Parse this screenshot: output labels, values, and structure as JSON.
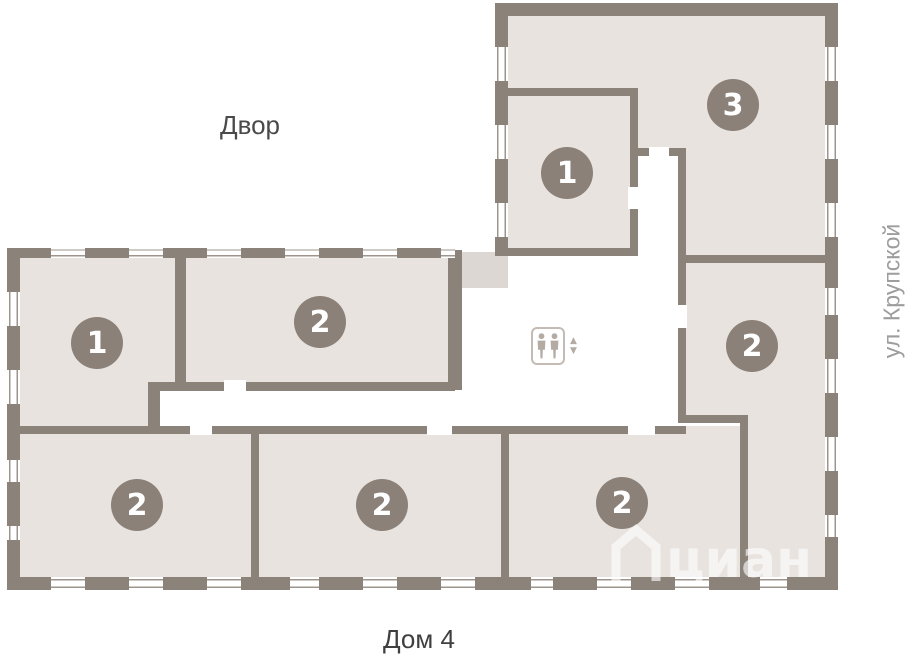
{
  "plan": {
    "area_labels": {
      "courtyard": "Двор",
      "street": "ул. Крупской",
      "house": "Дом 4"
    },
    "watermark_text": "циан",
    "unit_badges": [
      {
        "room": "top-wing-inner",
        "label": "1"
      },
      {
        "room": "top-wing-main",
        "label": "3"
      },
      {
        "room": "right-middle",
        "label": "2"
      },
      {
        "room": "left-upper-west",
        "label": "1"
      },
      {
        "room": "left-upper-east",
        "label": "2"
      },
      {
        "room": "bottom-left",
        "label": "2"
      },
      {
        "room": "bottom-middle",
        "label": "2"
      },
      {
        "room": "bottom-right",
        "label": "2"
      }
    ],
    "icons": {
      "elevator_up": "▲",
      "elevator_down": "▼"
    },
    "colors": {
      "wall": "#8b8279",
      "room_fill": "#e8e3df",
      "vestibule_fill": "#dcd7d2",
      "badge": "#8b8179",
      "badge_text": "#ffffff",
      "courtyard_label": "#4a4a4a",
      "street_label": "#9d9d9d",
      "house_label": "#3f3f3f",
      "watermark": "#ffffff"
    }
  }
}
